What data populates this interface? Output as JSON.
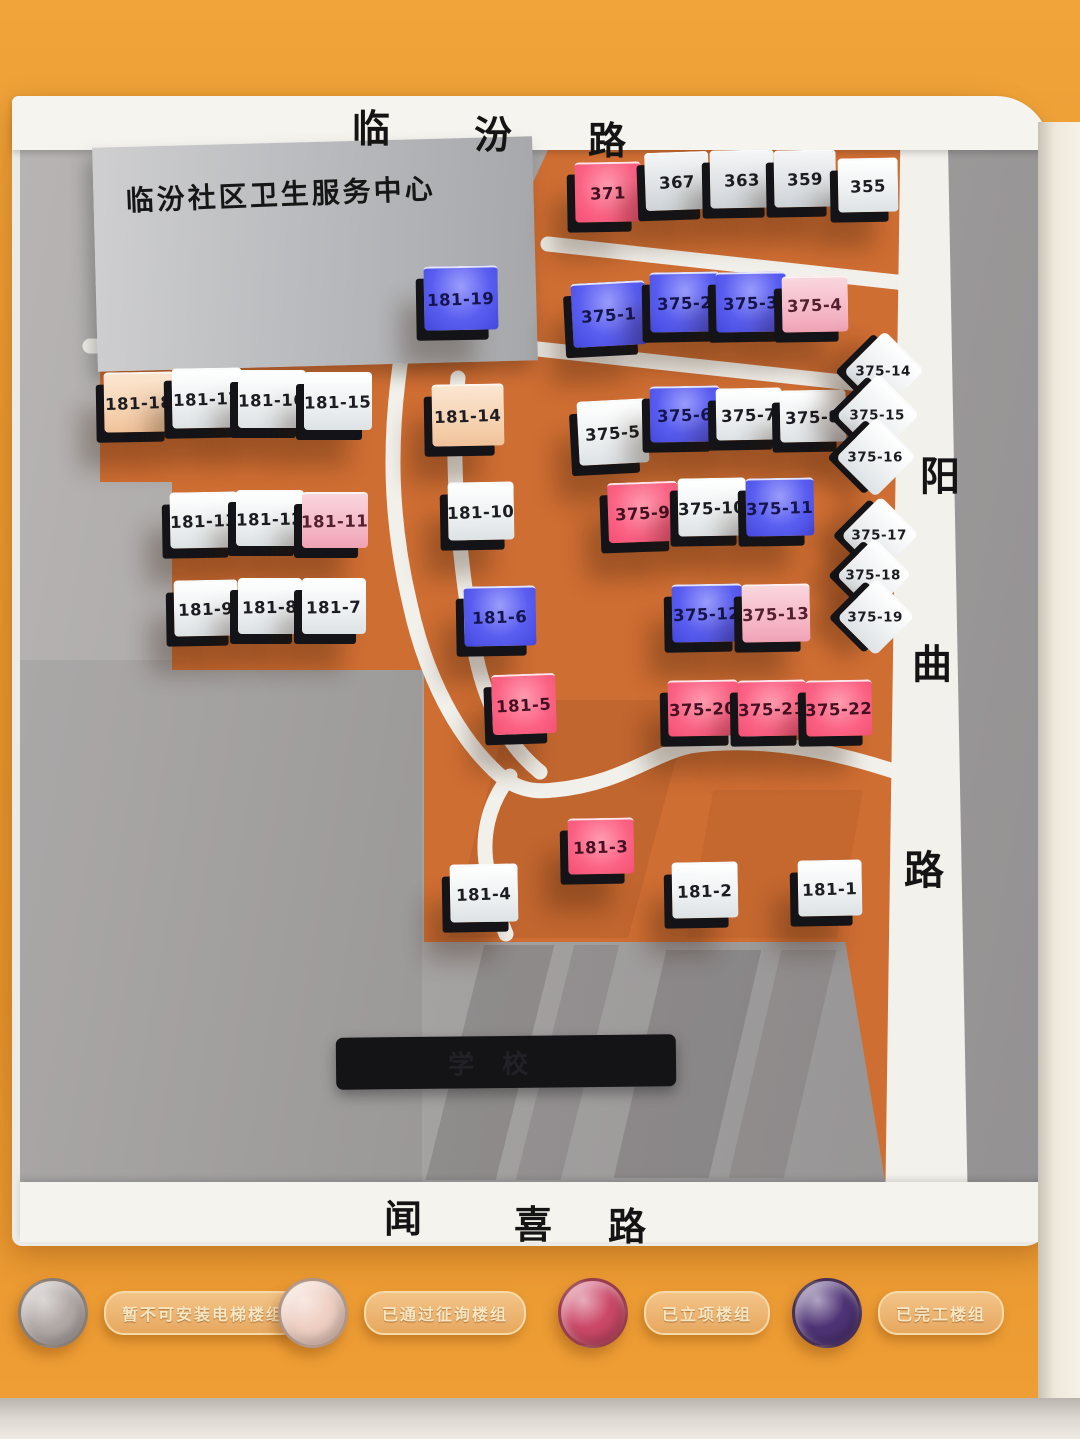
{
  "streets": {
    "top": {
      "name": "临汾路",
      "chars": [
        "临",
        "汾",
        "路"
      ]
    },
    "right": {
      "name": "阳曲路",
      "chars": [
        "阳",
        "曲",
        "路"
      ]
    },
    "bottom": {
      "name": "闻喜路",
      "chars": [
        "闻",
        "喜",
        "路"
      ]
    }
  },
  "landmarks": {
    "health_center": "临汾社区卫生服务中心",
    "school_sign": "学校"
  },
  "legend": {
    "items": [
      {
        "label": "暂不可安装电梯楼组",
        "color": "#b2a9a6"
      },
      {
        "label": "已通过征询楼组",
        "color": "#efcfc2"
      },
      {
        "label": "已立项楼组",
        "color": "#cb4868"
      },
      {
        "label": "已完工楼组",
        "color": "#4e3375"
      }
    ]
  },
  "state_colors": {
    "white": "#f2f4f5",
    "gray": "#dde1e4",
    "blue": "#5a5ef0",
    "pink": "#f4b3c3",
    "red": "#fb6284",
    "warm": "#f4cda9"
  },
  "tiles": [
    {
      "label": "371",
      "state": "red",
      "shape": "rect",
      "x": 575,
      "y": 162,
      "w": 66,
      "h": 58,
      "rot": -1
    },
    {
      "label": "367",
      "state": "gray",
      "shape": "rect",
      "x": 645,
      "y": 152,
      "w": 64,
      "h": 56,
      "rot": -2
    },
    {
      "label": "363",
      "state": "gray",
      "shape": "rect",
      "x": 710,
      "y": 150,
      "w": 64,
      "h": 56,
      "rot": -1
    },
    {
      "label": "359",
      "state": "gray",
      "shape": "rect",
      "x": 774,
      "y": 150,
      "w": 62,
      "h": 55,
      "rot": -1
    },
    {
      "label": "355",
      "state": "white",
      "shape": "rect",
      "x": 838,
      "y": 158,
      "w": 60,
      "h": 52,
      "rot": -1
    },
    {
      "label": "181-19",
      "state": "blue",
      "shape": "rect",
      "x": 424,
      "y": 266,
      "w": 74,
      "h": 62,
      "rot": -1
    },
    {
      "label": "375-1",
      "state": "blue",
      "shape": "rect",
      "x": 572,
      "y": 282,
      "w": 74,
      "h": 62,
      "rot": -3
    },
    {
      "label": "375-2",
      "state": "blue",
      "shape": "rect",
      "x": 650,
      "y": 272,
      "w": 70,
      "h": 58,
      "rot": -1
    },
    {
      "label": "375-3",
      "state": "blue",
      "shape": "rect",
      "x": 716,
      "y": 272,
      "w": 70,
      "h": 58,
      "rot": -1
    },
    {
      "label": "375-4",
      "state": "pink",
      "shape": "rect",
      "x": 782,
      "y": 276,
      "w": 66,
      "h": 54,
      "rot": -1
    },
    {
      "label": "181-18",
      "state": "warm",
      "shape": "rect",
      "x": 104,
      "y": 372,
      "w": 70,
      "h": 58,
      "rot": -1
    },
    {
      "label": "181-17",
      "state": "white",
      "shape": "rect",
      "x": 172,
      "y": 368,
      "w": 70,
      "h": 58,
      "rot": -1
    },
    {
      "label": "181-16",
      "state": "white",
      "shape": "rect",
      "x": 238,
      "y": 370,
      "w": 68,
      "h": 56,
      "rot": 0
    },
    {
      "label": "181-15",
      "state": "white",
      "shape": "rect",
      "x": 304,
      "y": 372,
      "w": 68,
      "h": 56,
      "rot": 0
    },
    {
      "label": "181-14",
      "state": "warm",
      "shape": "rect",
      "x": 432,
      "y": 384,
      "w": 72,
      "h": 60,
      "rot": -1
    },
    {
      "label": "375-5",
      "state": "white",
      "shape": "rect",
      "x": 578,
      "y": 400,
      "w": 70,
      "h": 62,
      "rot": -3
    },
    {
      "label": "375-6",
      "state": "blue",
      "shape": "rect",
      "x": 650,
      "y": 386,
      "w": 70,
      "h": 54,
      "rot": -1
    },
    {
      "label": "375-7",
      "state": "white",
      "shape": "rect",
      "x": 716,
      "y": 388,
      "w": 66,
      "h": 50,
      "rot": -1
    },
    {
      "label": "375-8",
      "state": "white",
      "shape": "rect",
      "x": 780,
      "y": 390,
      "w": 66,
      "h": 50,
      "rot": -1
    },
    {
      "label": "375-14",
      "state": "white",
      "shape": "diamond",
      "x": 856,
      "y": 342,
      "w": 56,
      "h": 56,
      "rot": 0
    },
    {
      "label": "375-15",
      "state": "white",
      "shape": "diamond",
      "x": 849,
      "y": 385,
      "w": 58,
      "h": 58,
      "rot": 0
    },
    {
      "label": "375-16",
      "state": "white",
      "shape": "diamond",
      "x": 848,
      "y": 428,
      "w": 56,
      "h": 56,
      "rot": 0
    },
    {
      "label": "181-13",
      "state": "white",
      "shape": "rect",
      "x": 170,
      "y": 492,
      "w": 68,
      "h": 54,
      "rot": -1
    },
    {
      "label": "181-12",
      "state": "white",
      "shape": "rect",
      "x": 236,
      "y": 490,
      "w": 68,
      "h": 54,
      "rot": 0
    },
    {
      "label": "181-11",
      "state": "pink",
      "shape": "rect",
      "x": 302,
      "y": 492,
      "w": 66,
      "h": 54,
      "rot": 0
    },
    {
      "label": "181-10",
      "state": "white",
      "shape": "rect",
      "x": 448,
      "y": 482,
      "w": 66,
      "h": 56,
      "rot": -1
    },
    {
      "label": "375-9",
      "state": "red",
      "shape": "rect",
      "x": 608,
      "y": 482,
      "w": 70,
      "h": 58,
      "rot": -2
    },
    {
      "label": "375-10",
      "state": "white",
      "shape": "rect",
      "x": 678,
      "y": 478,
      "w": 68,
      "h": 56,
      "rot": -1
    },
    {
      "label": "375-11",
      "state": "blue",
      "shape": "rect",
      "x": 746,
      "y": 478,
      "w": 68,
      "h": 56,
      "rot": -1
    },
    {
      "label": "375-17",
      "state": "white",
      "shape": "diamond",
      "x": 853,
      "y": 507,
      "w": 54,
      "h": 54,
      "rot": 0
    },
    {
      "label": "375-18",
      "state": "white",
      "shape": "diamond",
      "x": 848,
      "y": 548,
      "w": 52,
      "h": 52,
      "rot": 0
    },
    {
      "label": "375-19",
      "state": "white",
      "shape": "diamond",
      "x": 849,
      "y": 589,
      "w": 54,
      "h": 54,
      "rot": 0
    },
    {
      "label": "181-9",
      "state": "white",
      "shape": "rect",
      "x": 174,
      "y": 580,
      "w": 64,
      "h": 54,
      "rot": -1
    },
    {
      "label": "181-8",
      "state": "white",
      "shape": "rect",
      "x": 238,
      "y": 578,
      "w": 64,
      "h": 54,
      "rot": 0
    },
    {
      "label": "181-7",
      "state": "white",
      "shape": "rect",
      "x": 302,
      "y": 578,
      "w": 64,
      "h": 54,
      "rot": 0
    },
    {
      "label": "181-6",
      "state": "blue",
      "shape": "rect",
      "x": 464,
      "y": 586,
      "w": 72,
      "h": 58,
      "rot": -1
    },
    {
      "label": "375-12",
      "state": "blue",
      "shape": "rect",
      "x": 672,
      "y": 584,
      "w": 70,
      "h": 56,
      "rot": -1
    },
    {
      "label": "375-13",
      "state": "pink",
      "shape": "rect",
      "x": 742,
      "y": 584,
      "w": 68,
      "h": 56,
      "rot": -1
    },
    {
      "label": "181-5",
      "state": "red",
      "shape": "rect",
      "x": 492,
      "y": 674,
      "w": 64,
      "h": 58,
      "rot": -2
    },
    {
      "label": "375-20",
      "state": "red",
      "shape": "rect",
      "x": 668,
      "y": 680,
      "w": 70,
      "h": 54,
      "rot": -1
    },
    {
      "label": "375-21",
      "state": "red",
      "shape": "rect",
      "x": 738,
      "y": 680,
      "w": 68,
      "h": 54,
      "rot": -1
    },
    {
      "label": "375-22",
      "state": "red",
      "shape": "rect",
      "x": 806,
      "y": 680,
      "w": 66,
      "h": 54,
      "rot": -1
    },
    {
      "label": "181-3",
      "state": "red",
      "shape": "rect",
      "x": 568,
      "y": 818,
      "w": 66,
      "h": 54,
      "rot": -1
    },
    {
      "label": "181-4",
      "state": "white",
      "shape": "rect",
      "x": 450,
      "y": 864,
      "w": 68,
      "h": 56,
      "rot": -1
    },
    {
      "label": "181-2",
      "state": "white",
      "shape": "rect",
      "x": 672,
      "y": 862,
      "w": 66,
      "h": 54,
      "rot": -1
    },
    {
      "label": "181-1",
      "state": "white",
      "shape": "rect",
      "x": 798,
      "y": 860,
      "w": 64,
      "h": 54,
      "rot": -1
    }
  ]
}
